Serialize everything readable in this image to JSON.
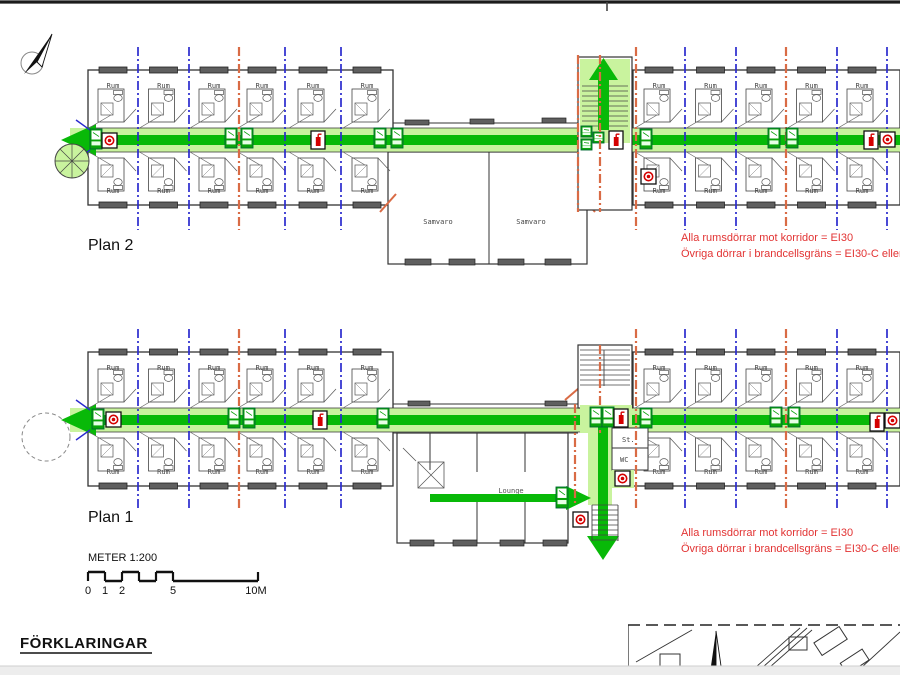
{
  "drawing": {
    "plan2_label": "Plan 2",
    "plan1_label": "Plan 1",
    "room": "Rum",
    "samvaro": "Samvaro",
    "lounge": "Lounge",
    "storage": "St.",
    "wc": "WC",
    "fire_note_line1": "Alla rumsdörrar mot korridor = EI30",
    "fire_note_line2": "Övriga dörrar i brandcellsgräns = EI30-C eller E",
    "scale_label": "METER 1:200",
    "scale_ticks": [
      "0",
      "1",
      "2",
      "5",
      "10M"
    ],
    "legend_heading": "FÖRKLARINGAR"
  },
  "icons": {
    "north_arrow": "north-arrow",
    "exit_sign": "exit-sign",
    "fire_extinguisher": "fire-extinguisher",
    "alarm_button": "fire-alarm-button",
    "spiral_stair": "spiral-stair"
  },
  "colors": {
    "route_green": "#08b908",
    "route_light": "#c9f39e",
    "exit_green": "#09a309",
    "cell_blue": "#2a2ace",
    "compartment_orange": "#d96b45",
    "alarm_red": "#d40000",
    "note_red": "#e23333",
    "wall": "#333333",
    "window_fill": "#5f5f5f"
  }
}
